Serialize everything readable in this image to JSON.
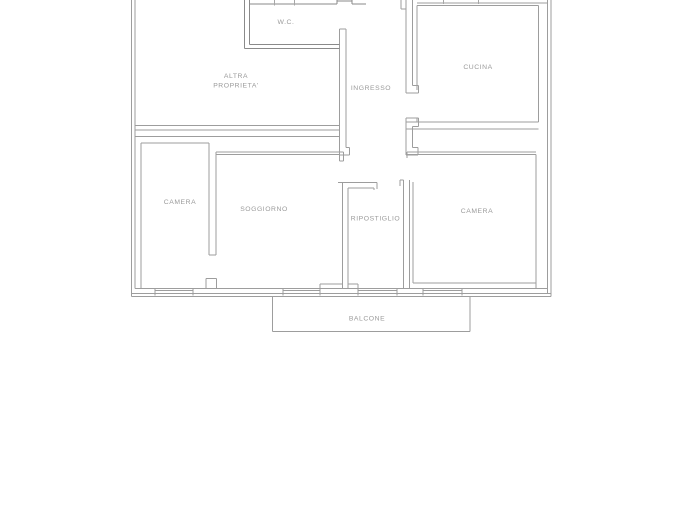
{
  "document": {
    "type": "apartment-floor-plan"
  },
  "rooms": {
    "wc": {
      "label": "W.C."
    },
    "altra_proprieta": {
      "line1": "ALTRA",
      "line2": "PROPRIETA'"
    },
    "ingresso": {
      "label": "INGRESSO"
    },
    "cucina": {
      "label": "CUCINA"
    },
    "camera_left": {
      "label": "CAMERA"
    },
    "soggiorno": {
      "label": "SOGGIORNO"
    },
    "ripostiglio": {
      "label": "RIPOSTIGLIO"
    },
    "camera_right": {
      "label": "CAMERA"
    },
    "balcone": {
      "label": "BALCONE"
    }
  },
  "colors": {
    "background": "#ffffff",
    "wall": "#9d9d9d",
    "wall_dark": "#8a8a8a",
    "tick": "#a6a6a6",
    "text": "#9a9a9a"
  }
}
